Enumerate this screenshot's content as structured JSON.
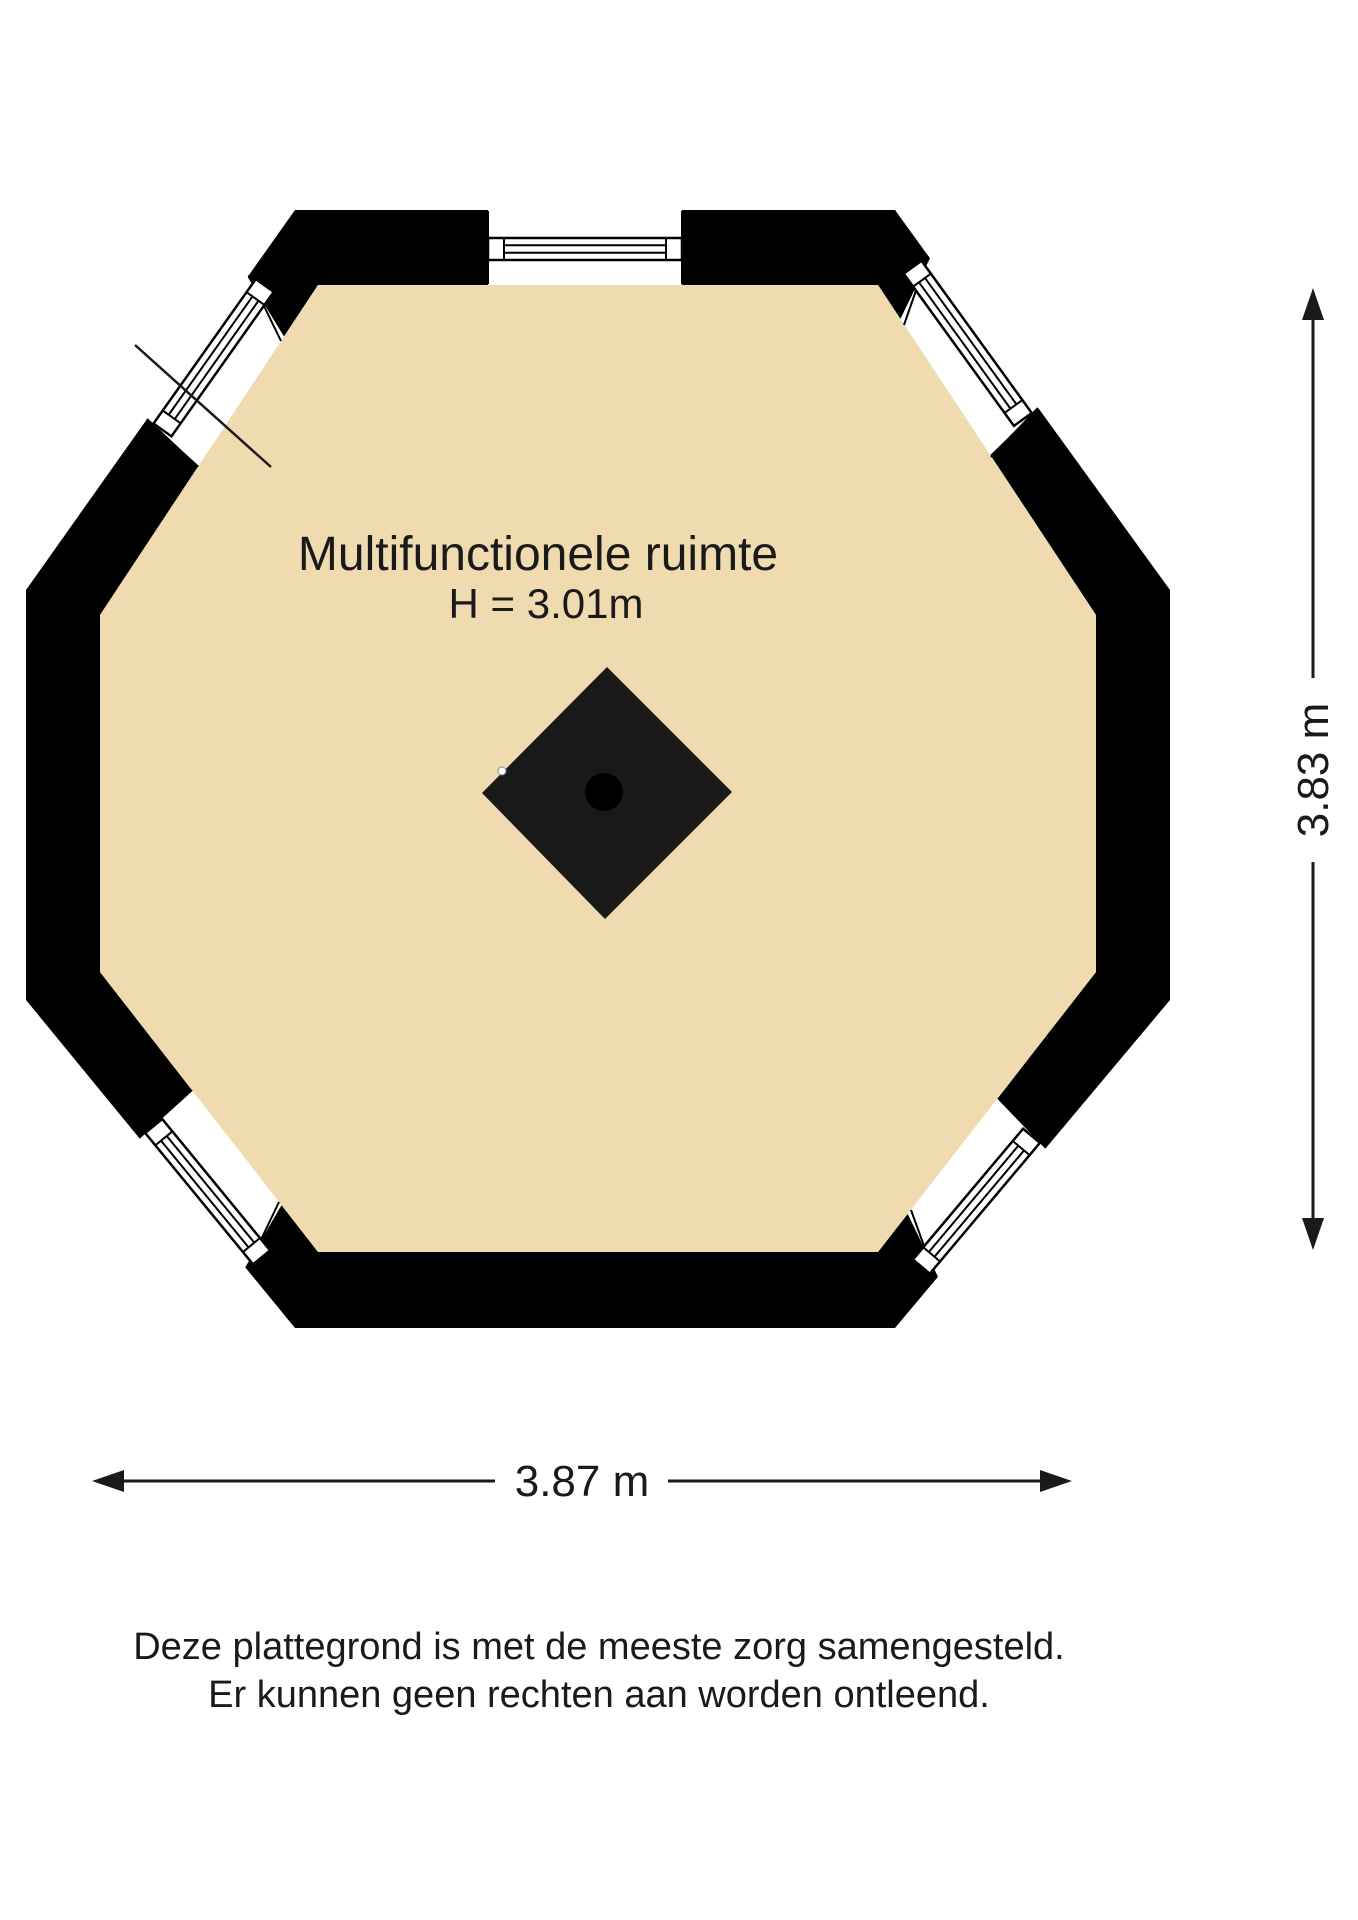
{
  "plan": {
    "room_label": "Multifunctionele ruimte",
    "room_height_label": "H = 3.01m"
  },
  "dimensions": {
    "vertical_label": "3.83 m",
    "horizontal_label": "3.87 m"
  },
  "disclaimer": {
    "line1": "Deze plattegrond is met de meeste zorg samengesteld.",
    "line2": "Er kunnen geen rechten aan worden ontleend."
  },
  "colors": {
    "floor": "#f0dbb0",
    "wall": "#000000",
    "window_fill": "#ffffff",
    "line": "#1a1a1a",
    "column": "#191919"
  }
}
